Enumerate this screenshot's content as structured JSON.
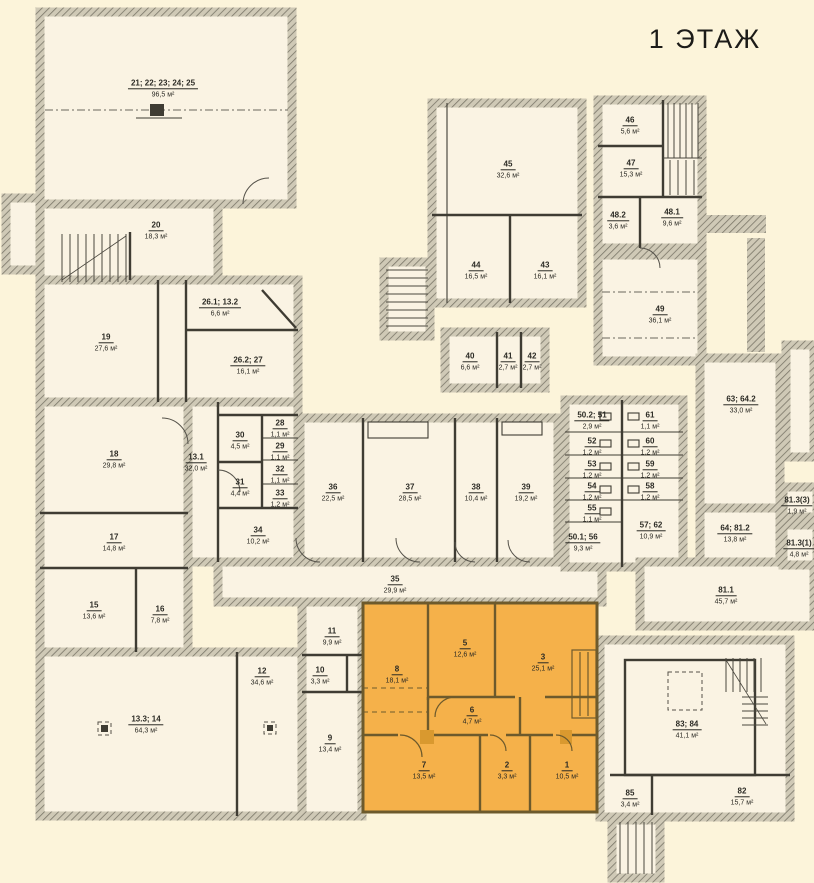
{
  "title": "1 ЭТАЖ",
  "colors": {
    "background": "#fcf4da",
    "room_fill": "#faf3e3",
    "wall_dark": "#3f3c33",
    "wall_hatch": "#7a7668",
    "wall_hatch_bg": "#cfc9b6",
    "highlight_fill": "#f5b14a",
    "highlight_wall": "#6d5a2c"
  },
  "rooms": [
    {
      "number": "21; 22; 23; 24; 25",
      "area": "96,5 м²",
      "x": 163,
      "y": 86,
      "highlight": false
    },
    {
      "number": "20",
      "area": "18,3 м²",
      "x": 156,
      "y": 228,
      "highlight": false
    },
    {
      "number": "19",
      "area": "27,6 м²",
      "x": 106,
      "y": 340,
      "highlight": false
    },
    {
      "number": "26.1; 13.2",
      "area": "6,6 м²",
      "x": 220,
      "y": 305,
      "highlight": false
    },
    {
      "number": "26.2; 27",
      "area": "16,1 м²",
      "x": 248,
      "y": 363,
      "highlight": false
    },
    {
      "number": "18",
      "area": "29,8 м²",
      "x": 114,
      "y": 457,
      "highlight": false
    },
    {
      "number": "13.1",
      "area": "32,0 м²",
      "x": 196,
      "y": 460,
      "highlight": false
    },
    {
      "number": "30",
      "area": "4,5 м²",
      "x": 240,
      "y": 438,
      "highlight": false
    },
    {
      "number": "28",
      "area": "1,1 м²",
      "x": 280,
      "y": 426,
      "highlight": false
    },
    {
      "number": "29",
      "area": "1,1 м²",
      "x": 280,
      "y": 449,
      "highlight": false
    },
    {
      "number": "31",
      "area": "4,4 м²",
      "x": 240,
      "y": 485,
      "highlight": false
    },
    {
      "number": "32",
      "area": "1,1 м²",
      "x": 280,
      "y": 472,
      "highlight": false
    },
    {
      "number": "33",
      "area": "1,2 м²",
      "x": 280,
      "y": 496,
      "highlight": false
    },
    {
      "number": "34",
      "area": "10,2 м²",
      "x": 258,
      "y": 533,
      "highlight": false
    },
    {
      "number": "17",
      "area": "14,8 м²",
      "x": 114,
      "y": 540,
      "highlight": false
    },
    {
      "number": "15",
      "area": "13,6 м²",
      "x": 94,
      "y": 608,
      "highlight": false
    },
    {
      "number": "16",
      "area": "7,8 м²",
      "x": 160,
      "y": 612,
      "highlight": false
    },
    {
      "number": "13.3; 14",
      "area": "64,3 м²",
      "x": 146,
      "y": 722,
      "highlight": false
    },
    {
      "number": "12",
      "area": "34,6 м²",
      "x": 262,
      "y": 674,
      "highlight": false
    },
    {
      "number": "11",
      "area": "9,9 м²",
      "x": 332,
      "y": 634,
      "highlight": false
    },
    {
      "number": "10",
      "area": "3,3 м²",
      "x": 320,
      "y": 673,
      "highlight": false
    },
    {
      "number": "9",
      "area": "13,4 м²",
      "x": 330,
      "y": 741,
      "highlight": false
    },
    {
      "number": "36",
      "area": "22,5 м²",
      "x": 333,
      "y": 490,
      "highlight": false
    },
    {
      "number": "37",
      "area": "28,5 м²",
      "x": 410,
      "y": 490,
      "highlight": false
    },
    {
      "number": "38",
      "area": "10,4 м²",
      "x": 476,
      "y": 490,
      "highlight": false
    },
    {
      "number": "39",
      "area": "19,2 м²",
      "x": 526,
      "y": 490,
      "highlight": false
    },
    {
      "number": "35",
      "area": "29,9 м²",
      "x": 395,
      "y": 582,
      "highlight": false
    },
    {
      "number": "45",
      "area": "32,6 м²",
      "x": 508,
      "y": 167,
      "highlight": false
    },
    {
      "number": "44",
      "area": "16,5 м²",
      "x": 476,
      "y": 268,
      "highlight": false
    },
    {
      "number": "43",
      "area": "16,1 м²",
      "x": 545,
      "y": 268,
      "highlight": false
    },
    {
      "number": "40",
      "area": "6,6 м²",
      "x": 470,
      "y": 359,
      "highlight": false
    },
    {
      "number": "41",
      "area": "2,7 м²",
      "x": 508,
      "y": 359,
      "highlight": false
    },
    {
      "number": "42",
      "area": "2,7 м²",
      "x": 532,
      "y": 359,
      "highlight": false
    },
    {
      "number": "46",
      "area": "5,6 м²",
      "x": 630,
      "y": 123,
      "highlight": false
    },
    {
      "number": "47",
      "area": "15,3 м²",
      "x": 631,
      "y": 166,
      "highlight": false
    },
    {
      "number": "48.2",
      "area": "3,6 м²",
      "x": 618,
      "y": 218,
      "highlight": false
    },
    {
      "number": "48.1",
      "area": "9,6 м²",
      "x": 672,
      "y": 215,
      "highlight": false
    },
    {
      "number": "49",
      "area": "36,1 м²",
      "x": 660,
      "y": 312,
      "highlight": false
    },
    {
      "number": "50.2; 51",
      "area": "2,9 м²",
      "x": 592,
      "y": 418,
      "highlight": false
    },
    {
      "number": "52",
      "area": "1,2 м²",
      "x": 592,
      "y": 444,
      "highlight": false
    },
    {
      "number": "53",
      "area": "1,2 м²",
      "x": 592,
      "y": 467,
      "highlight": false
    },
    {
      "number": "54",
      "area": "1,2 м²",
      "x": 592,
      "y": 489,
      "highlight": false
    },
    {
      "number": "55",
      "area": "1,1 м²",
      "x": 592,
      "y": 511,
      "highlight": false
    },
    {
      "number": "50.1; 56",
      "area": "9,3 м²",
      "x": 583,
      "y": 540,
      "highlight": false
    },
    {
      "number": "61",
      "area": "1,1 м²",
      "x": 650,
      "y": 418,
      "highlight": false
    },
    {
      "number": "60",
      "area": "1,2 м²",
      "x": 650,
      "y": 444,
      "highlight": false
    },
    {
      "number": "59",
      "area": "1,2 м²",
      "x": 650,
      "y": 467,
      "highlight": false
    },
    {
      "number": "58",
      "area": "1,2 м²",
      "x": 650,
      "y": 489,
      "highlight": false
    },
    {
      "number": "57; 62",
      "area": "10,9 м²",
      "x": 651,
      "y": 528,
      "highlight": false
    },
    {
      "number": "63; 64.2",
      "area": "33,0 м²",
      "x": 741,
      "y": 402,
      "highlight": false
    },
    {
      "number": "64; 81.2",
      "area": "13,8 м²",
      "x": 735,
      "y": 531,
      "highlight": false
    },
    {
      "number": "81.3(3)",
      "area": "1,9 м²",
      "x": 797,
      "y": 503,
      "highlight": false
    },
    {
      "number": "81.3(1)",
      "area": "4,8 м²",
      "x": 799,
      "y": 546,
      "highlight": false
    },
    {
      "number": "81.1",
      "area": "45,7 м²",
      "x": 726,
      "y": 593,
      "highlight": false
    },
    {
      "number": "83; 84",
      "area": "41,1 м²",
      "x": 687,
      "y": 727,
      "highlight": false
    },
    {
      "number": "85",
      "area": "3,4 м²",
      "x": 630,
      "y": 796,
      "highlight": false
    },
    {
      "number": "82",
      "area": "15,7 м²",
      "x": 742,
      "y": 794,
      "highlight": false
    },
    {
      "number": "8",
      "area": "18,1 м²",
      "x": 397,
      "y": 672,
      "highlight": true
    },
    {
      "number": "5",
      "area": "12,6 м²",
      "x": 465,
      "y": 646,
      "highlight": true
    },
    {
      "number": "3",
      "area": "25,1 м²",
      "x": 543,
      "y": 660,
      "highlight": true
    },
    {
      "number": "6",
      "area": "4,7 м²",
      "x": 472,
      "y": 713,
      "highlight": true
    },
    {
      "number": "7",
      "area": "13,5 м²",
      "x": 424,
      "y": 768,
      "highlight": true
    },
    {
      "number": "2",
      "area": "3,3 м²",
      "x": 507,
      "y": 768,
      "highlight": true
    },
    {
      "number": "1",
      "area": "10,5 м²",
      "x": 567,
      "y": 768,
      "highlight": true
    }
  ]
}
